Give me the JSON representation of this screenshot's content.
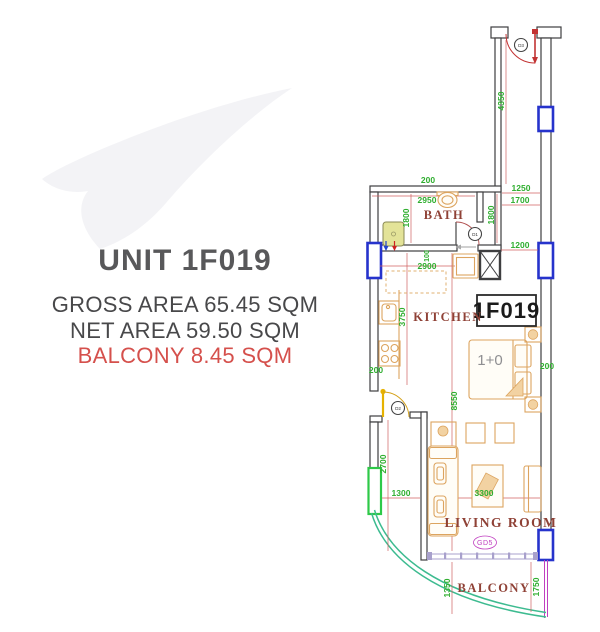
{
  "colors": {
    "heading": "#58585a",
    "body-text": "#48484a",
    "accent-red": "#d5504c",
    "wall": "#3e3e40",
    "dim-green": "#2fae2f",
    "dim-line-red": "#d06060",
    "room-label": "#8f4136",
    "window-blue": "#2633cc",
    "window-green": "#2ec948",
    "balcony-rail": "#3dbb90",
    "door-red": "#c23333",
    "door-yellow": "#e6b200",
    "furniture": "#dca45f",
    "magenta": "#c03fc0",
    "sill": "#a8a0cc",
    "watermark": "#f3f3f6"
  },
  "info": {
    "unit_title": "UNIT 1F019",
    "gross_area": "GROSS AREA 65.45 SQM",
    "net_area": "NET AREA 59.50 SQM",
    "balcony_area": "BALCONY 8.45 SQM"
  },
  "plan": {
    "unit_box": "1F019",
    "rooms": {
      "bath": "BATH",
      "kitchen": "KITCHEN",
      "living": "LIVING ROOM",
      "balcony": "BALCONY"
    },
    "bed_type": "1+0",
    "doors": {
      "d1": "D1",
      "d2": "D2",
      "d3": "D3"
    },
    "gate": "GD5",
    "dims": {
      "top200": "200",
      "w2950": "2950",
      "w1250": "1250",
      "w1700": "1700",
      "h4350": "4350",
      "h1800l": "1800",
      "h1800r": "1800",
      "w1200": "1200",
      "w100": "100",
      "w2900": "2900",
      "h3750": "3750",
      "h8550": "8550",
      "l200": "200",
      "r200": "200",
      "h2700": "2700",
      "w1300": "1300",
      "w3300": "3300",
      "h1350": "1350",
      "h1750": "1750"
    }
  }
}
